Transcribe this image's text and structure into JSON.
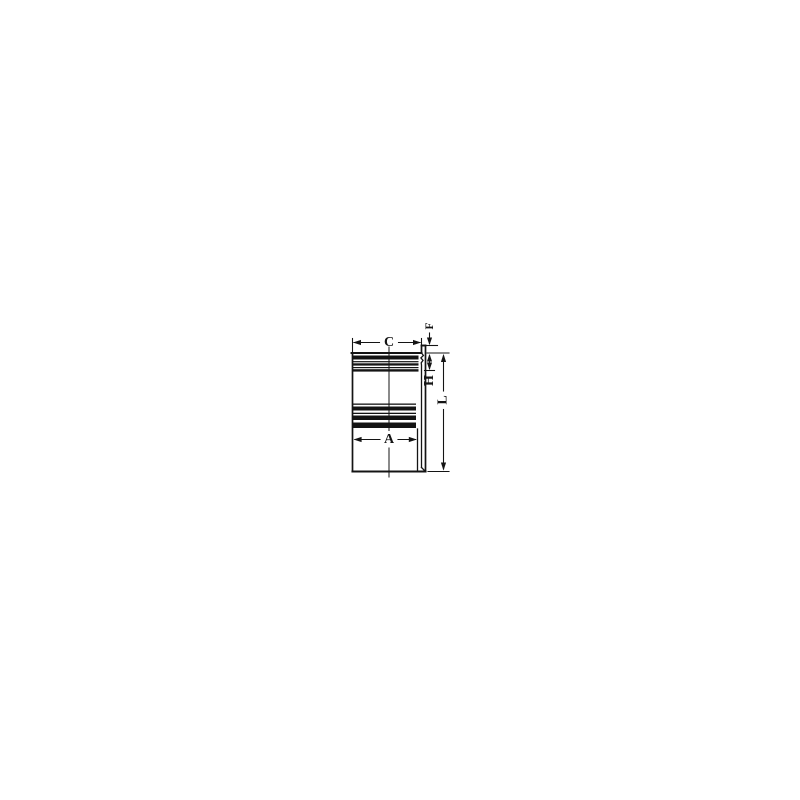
{
  "diagram": {
    "type": "technical-drawing",
    "subject": "cylinder-liner-section-view",
    "background_color": "#ffffff",
    "line_color": "#141414",
    "labels": {
      "c": "C",
      "f": "F",
      "h": "H",
      "a": "A",
      "l": "L"
    },
    "dimensions": [
      {
        "label": "C",
        "orientation": "horizontal",
        "position": "top-outer-diameter"
      },
      {
        "label": "F",
        "orientation": "vertical",
        "position": "top-right-collar-height"
      },
      {
        "label": "H",
        "orientation": "vertical",
        "position": "right-upper-depth"
      },
      {
        "label": "A",
        "orientation": "horizontal",
        "position": "inner-bore-diameter"
      },
      {
        "label": "L",
        "orientation": "vertical",
        "position": "right-total-length"
      }
    ]
  }
}
